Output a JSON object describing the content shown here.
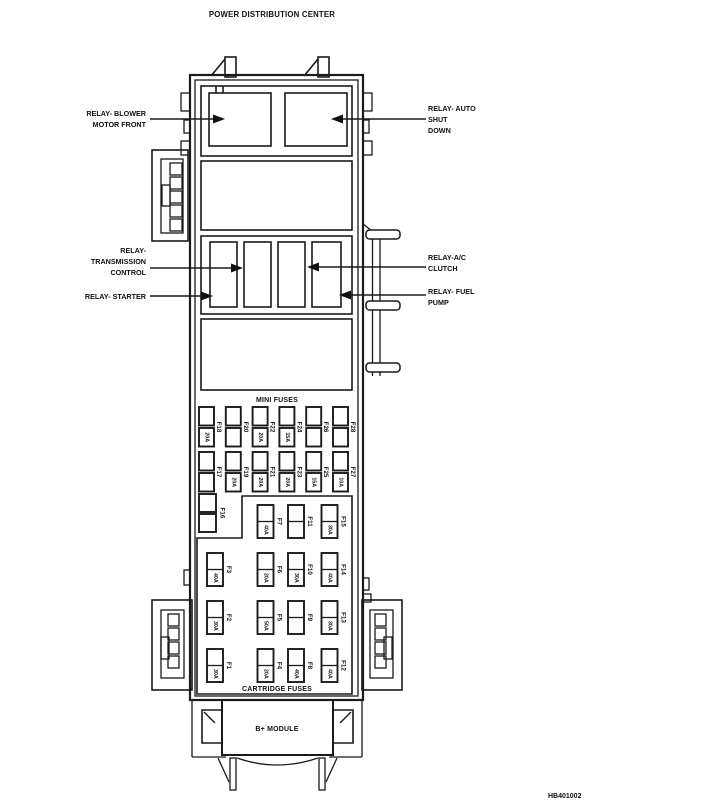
{
  "title": "POWER DISTRIBUTION CENTER",
  "footer_code": "HB401002",
  "captions": {
    "mini_fuses": "MINI FUSES",
    "cartridge_fuses": "CARTRIDGE FUSES",
    "b_module": "B+ MODULE"
  },
  "relays": {
    "blower": {
      "lines": [
        "RELAY- BLOWER",
        "MOTOR FRONT"
      ]
    },
    "auto_shutdown": {
      "lines": [
        "RELAY- AUTO",
        "SHUT",
        "DOWN"
      ]
    },
    "transmission": {
      "lines": [
        "RELAY-",
        "TRANSMISSION",
        "CONTROL"
      ]
    },
    "starter": {
      "lines": [
        "RELAY- STARTER"
      ]
    },
    "ac_clutch": {
      "lines": [
        "RELAY-A/C",
        "CLUTCH"
      ]
    },
    "fuel_pump": {
      "lines": [
        "RELAY- FUEL",
        "PUMP"
      ]
    }
  },
  "f16": {
    "label": "F16"
  },
  "mini_fuse_rows": [
    {
      "fuses": [
        {
          "label": "F18",
          "amp": "20A"
        },
        {
          "label": "F20",
          "amp": ""
        },
        {
          "label": "F22",
          "amp": "20A"
        },
        {
          "label": "F24",
          "amp": "15A"
        },
        {
          "label": "F26",
          "amp": ""
        },
        {
          "label": "F28",
          "amp": ""
        }
      ]
    },
    {
      "fuses": [
        {
          "label": "F17",
          "amp": ""
        },
        {
          "label": "F19",
          "amp": "20A"
        },
        {
          "label": "F21",
          "amp": "20A"
        },
        {
          "label": "F23",
          "amp": "20A"
        },
        {
          "label": "F25",
          "amp": "15A"
        },
        {
          "label": "F27",
          "amp": "10A"
        }
      ]
    }
  ],
  "cartridge_rows": [
    {
      "fuses": [
        null,
        {
          "label": "F7",
          "amp": "40A"
        },
        {
          "label": "F11",
          "amp": ""
        },
        {
          "label": "F15",
          "amp": "30A"
        }
      ]
    },
    {
      "fuses": [
        {
          "label": "F3",
          "amp": "40A"
        },
        {
          "label": "F6",
          "amp": "20A"
        },
        {
          "label": "F10",
          "amp": "30A"
        },
        {
          "label": "F14",
          "amp": "40A"
        }
      ]
    },
    {
      "fuses": [
        {
          "label": "F2",
          "amp": "30A"
        },
        {
          "label": "F5",
          "amp": "50A"
        },
        {
          "label": "F9",
          "amp": ""
        },
        {
          "label": "F13",
          "amp": "30A"
        }
      ]
    },
    {
      "fuses": [
        {
          "label": "F1",
          "amp": "30A"
        },
        {
          "label": "F4",
          "amp": "20A"
        },
        {
          "label": "F8",
          "amp": "40A"
        },
        {
          "label": "F12",
          "amp": "40A"
        }
      ]
    }
  ]
}
